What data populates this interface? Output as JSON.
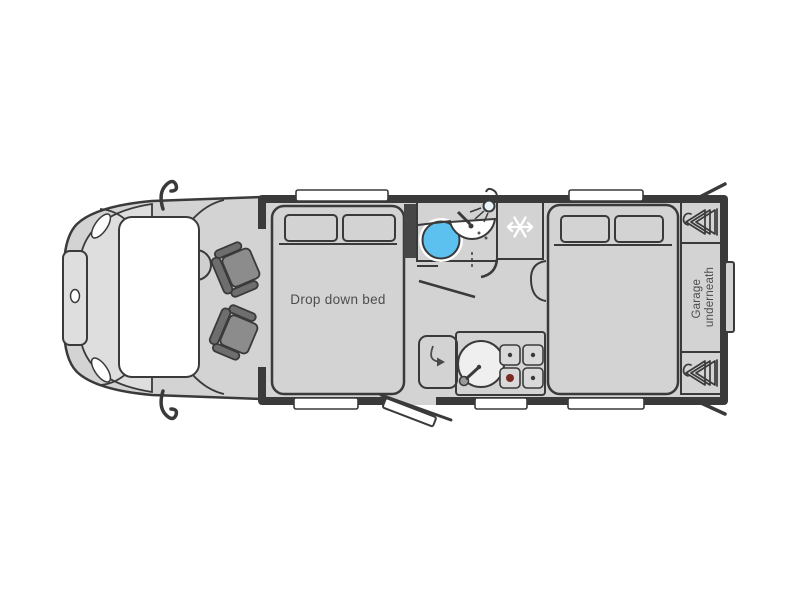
{
  "labels": {
    "drop_down_bed": "Drop down bed",
    "garage": [
      "Garage",
      "underneath"
    ]
  },
  "colors": {
    "wall": "#3a3a3a",
    "floor": "#d3d3d3",
    "bonnet": "#dedede",
    "bed": "#7e7e7e",
    "seat": "#8c8c8c",
    "seat_dark": "#6e6e6e",
    "counter": "#c6c6c6",
    "flap": "#cdcdcd",
    "fridge": "#c9cbce",
    "blue": "#5cc1ef",
    "cream": "#f2ead5",
    "white": "#ffffff",
    "cabinet": "#474747",
    "burner": "#7a2a22",
    "text": "#4d4d4d"
  },
  "icons": {
    "snowflake-icon": "❄ freezer/fridge",
    "wardrobe-hangers-icon": "⋘ clothes hangers on rail",
    "shower-head-icon": "shower head with spray",
    "toilet-icon": "round toilet bowl",
    "basin-icon": "half-round wash basin with tap",
    "sink-icon": "round kitchen sink with tap",
    "hob-icon": "4-burner gas hob",
    "swing-arrow-icon": "worktop flap swing arrow"
  }
}
